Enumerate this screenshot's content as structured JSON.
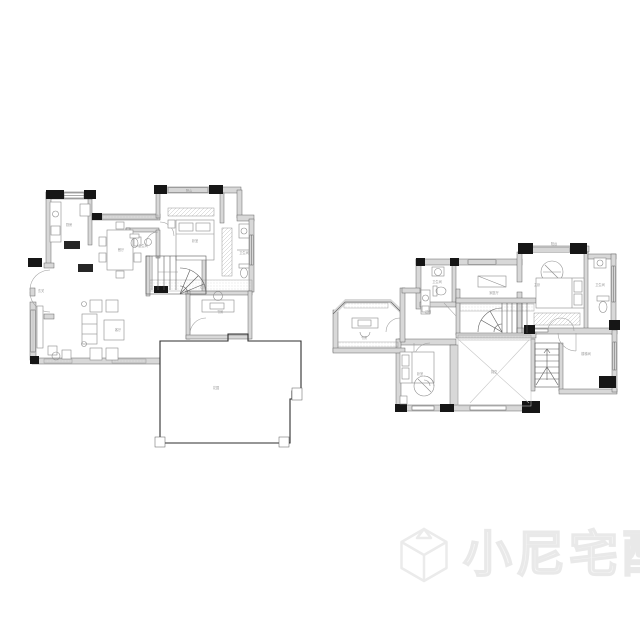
{
  "colors": {
    "background": "#ffffff",
    "wall_fill": "#d8d8d8",
    "wall_edge": "#5a5a5a",
    "column": "#161616",
    "outline": "#2e2e2e",
    "furniture": "#8d8d8d",
    "hatch": "#c3c3c3",
    "label": "#9a9a9a",
    "dark_fixture": "#262626",
    "watermark_stroke": "#e9e9e9",
    "watermark_fill": "#f6f6f6"
  },
  "plans": {
    "first_floor": {
      "labels": {
        "balcony": "阳台",
        "kitchen": "厨房",
        "dining": "餐厅",
        "bath_a": "卫生间",
        "bedroom": "卧室",
        "bath_b": "卫生间",
        "hallway": "过道",
        "living": "客厅",
        "study": "书房",
        "terrace": "花园",
        "entry": "玄关"
      }
    },
    "second_floor": {
      "labels": {
        "balcony": "阳台",
        "master_bedroom": "主卧",
        "master_bath": "卫生间",
        "family_room": "家庭厅",
        "bath": "卫生间",
        "corridor": "过道",
        "study": "书房",
        "bedroom": "卧室",
        "void": "挑空",
        "stair_room": "楼梯间"
      }
    }
  },
  "watermark": {
    "text": "小尼宅配",
    "logo": "cube-logo"
  }
}
